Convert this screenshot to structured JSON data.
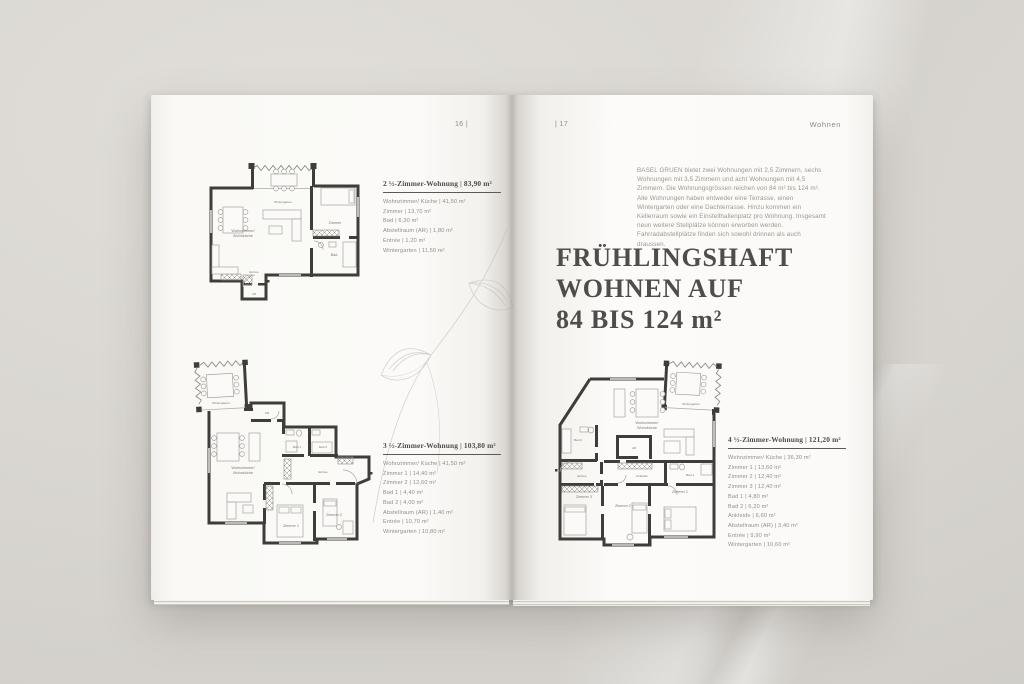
{
  "colors": {
    "backdrop": "#d8d5d0",
    "paper": "#fbfaf8",
    "ink": "#4e4d49",
    "muted_text": "#8f8e89",
    "plan_wall": "#3e3d39"
  },
  "header": {
    "left_page_number": "16 |",
    "right_page_number": "| 17",
    "section": "Wohnen"
  },
  "intro_text": "BASEL GRUEN bietet zwei Wohnungen mit 2,5 Zimmern, sechs Wohnungen mit 3,5 Zimmern und acht Wohnungen mit 4,5 Zimmern. Die Wohnungsgrössen reichen von 84 m² bis 124 m². Alle Wohnungen haben entweder eine Terrasse, einen Wintergarten oder eine Dachterrasse. Hinzu kommen ein Kellerraum sowie ein Einstellhallenplatz pro Wohnung. Insgesamt neun weitere Stellplätze können erworben werden. Fahrradabstellplätze finden sich sowohl drinnen als auch draussen.",
  "headline": {
    "line1": "FRÜHLINGSHAFT",
    "line2": "WOHNEN AUF",
    "line3": "84 BIS 124 m²"
  },
  "specs": [
    {
      "title": "2 ½-Zimmer-Wohnung | 83,90 m²",
      "rooms": [
        "Wohnzimmer/ Küche | 41,50 m²",
        "Zimmer | 13,70 m²",
        "Bad | 6,30 m²",
        "Abstellraum (AR) | 1,80 m²",
        "Entrée | 1,20 m²",
        "Wintergarten | 11,50 m²"
      ]
    },
    {
      "title": "3 ½-Zimmer-Wohnung | 103,80 m²",
      "rooms": [
        "Wohnzimmer/ Küche | 41,50 m²",
        "Zimmer 1 | 14,40 m²",
        "Zimmer 2 | 12,60 m²",
        "Bad 1 | 4,40 m²",
        "Bad 2 | 4,00 m²",
        "Abstellraum (AR) | 1,40 m²",
        "Entrée | 10,70 m²",
        "Wintergarten | 10,80 m²"
      ]
    },
    {
      "title": "4 ½-Zimmer-Wohnung | 121,20 m²",
      "rooms": [
        "Wohnzimmer/ Küche | 36,30 m²",
        "Zimmer 1 | 13,60 m²",
        "Zimmer 2 | 12,40 m²",
        "Zimmer 3 | 12,40 m²",
        "Bad 1 | 4,80 m²",
        "Bad 2 | 6,20 m²",
        "Ankleide | 6,60 m²",
        "Abstellraum (AR) | 3,40 m²",
        "Entrée | 9,90 m²",
        "Wintergarten | 10,60 m²"
      ]
    }
  ],
  "plans": {
    "p1": {
      "labels": {
        "wintergarten": "Wintergarten",
        "wohnzimmer_1": "Wohnzimmer/",
        "wohnzimmer_2": "Wohnküche",
        "zimmer": "Zimmer",
        "bad": "Bad",
        "entree": "Entrée",
        "ar": "AR"
      }
    },
    "p2": {
      "labels": {
        "wintergarten": "Wintergarten",
        "wohnzimmer_1": "Wohnzimmer/",
        "wohnzimmer_2": "Wohnküche",
        "ar": "AR",
        "bad1": "Bad 1",
        "bad2": "Bad 2",
        "entree": "Entrée",
        "zimmer1": "Zimmer 1",
        "zimmer2": "Zimmer 2"
      }
    },
    "p3": {
      "labels": {
        "wintergarten": "Wintergarten",
        "wohnzimmer_1": "Wohnzimmer/",
        "wohnzimmer_2": "Wohnküche",
        "ar": "AR",
        "bad1": "Bad 1",
        "bad2": "Bad 2",
        "entree": "Entrée",
        "ankleide": "Ankleide",
        "zimmer1": "Zimmer 1",
        "zimmer2": "Zimmer 2",
        "zimmer3": "Zimmer 3"
      }
    }
  }
}
